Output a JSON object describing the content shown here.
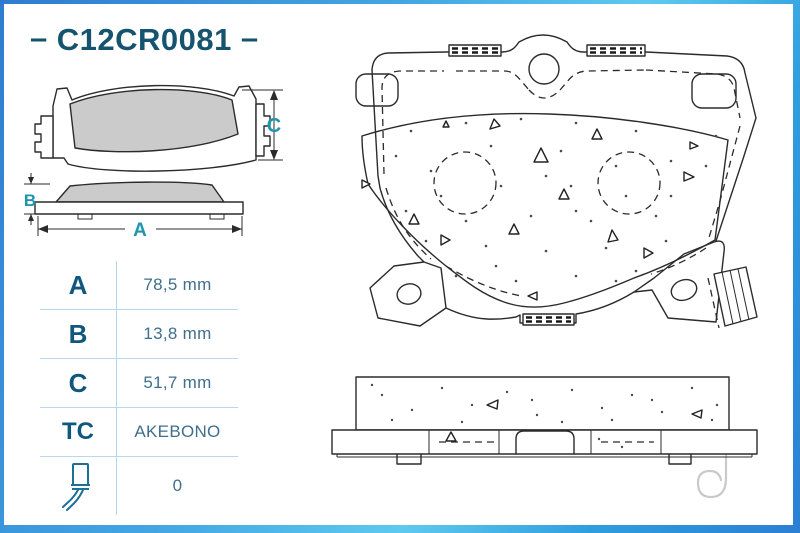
{
  "header": {
    "part_number_prefix": "–",
    "part_number": "C12CR0081",
    "part_number_suffix": "–"
  },
  "dimension_labels": {
    "a": "A",
    "b": "B",
    "c": "C"
  },
  "specs": {
    "rows": [
      {
        "label": "A",
        "value": "78,5 mm"
      },
      {
        "label": "B",
        "value": "13,8 mm"
      },
      {
        "label": "C",
        "value": "51,7 mm"
      },
      {
        "label": "TC",
        "value": "AKEBONO"
      },
      {
        "label": "",
        "value": "0",
        "icon": "wear-sensor-icon"
      }
    ]
  },
  "colors": {
    "frame_blue": "#2f7ccf",
    "frame_cyan": "#5ec9ef",
    "part_number_text": "#15536e",
    "table_label": "#10577e",
    "table_value": "#3f6f8d",
    "dimension_letter": "#1d95ac",
    "grid_line": "#b9d6ea",
    "pad_fill": "#cbcbcb",
    "drawing_line": "#2b2b2b",
    "cotter_pin_gray": "#c9c9c9"
  }
}
